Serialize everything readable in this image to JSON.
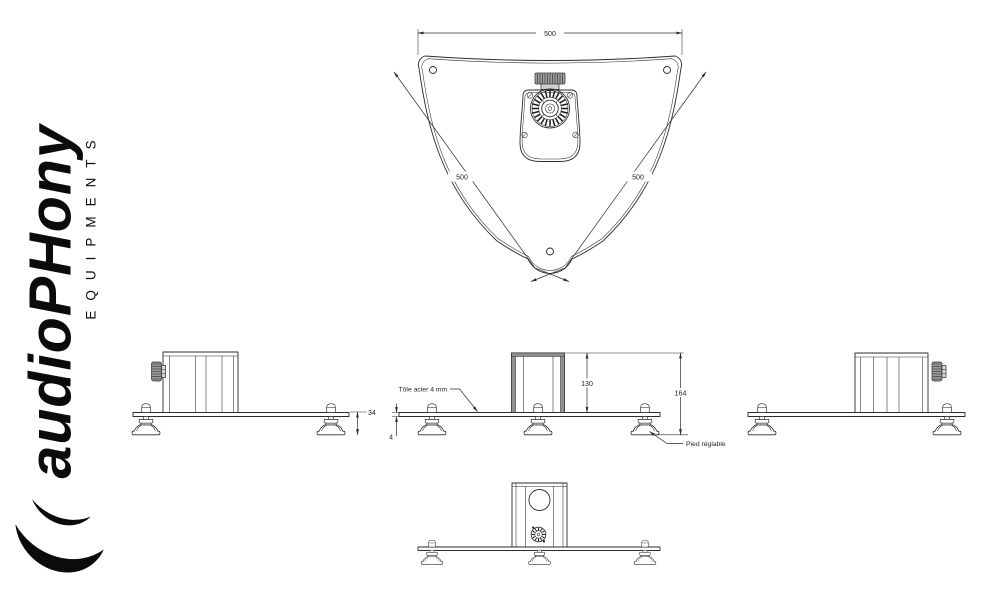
{
  "logo": {
    "brand": "audioPHony",
    "subtitle": "EQUIPMENTS",
    "mark": "double-crescent-icon"
  },
  "top_view": {
    "dim_width": "500",
    "dim_side_left": "500",
    "dim_side_right": "500"
  },
  "left_view": {
    "dim_foot_height": "34"
  },
  "center_view": {
    "dim_block_height": "130",
    "dim_total_height": "164",
    "dim_plate_thickness": "4",
    "note_sheet": "Tôle acier 4 mm",
    "note_foot": "Pied réglable"
  },
  "colors": {
    "line": "#2b2b2b",
    "logo": "#0b0b0b",
    "gray_band": "#909090"
  }
}
